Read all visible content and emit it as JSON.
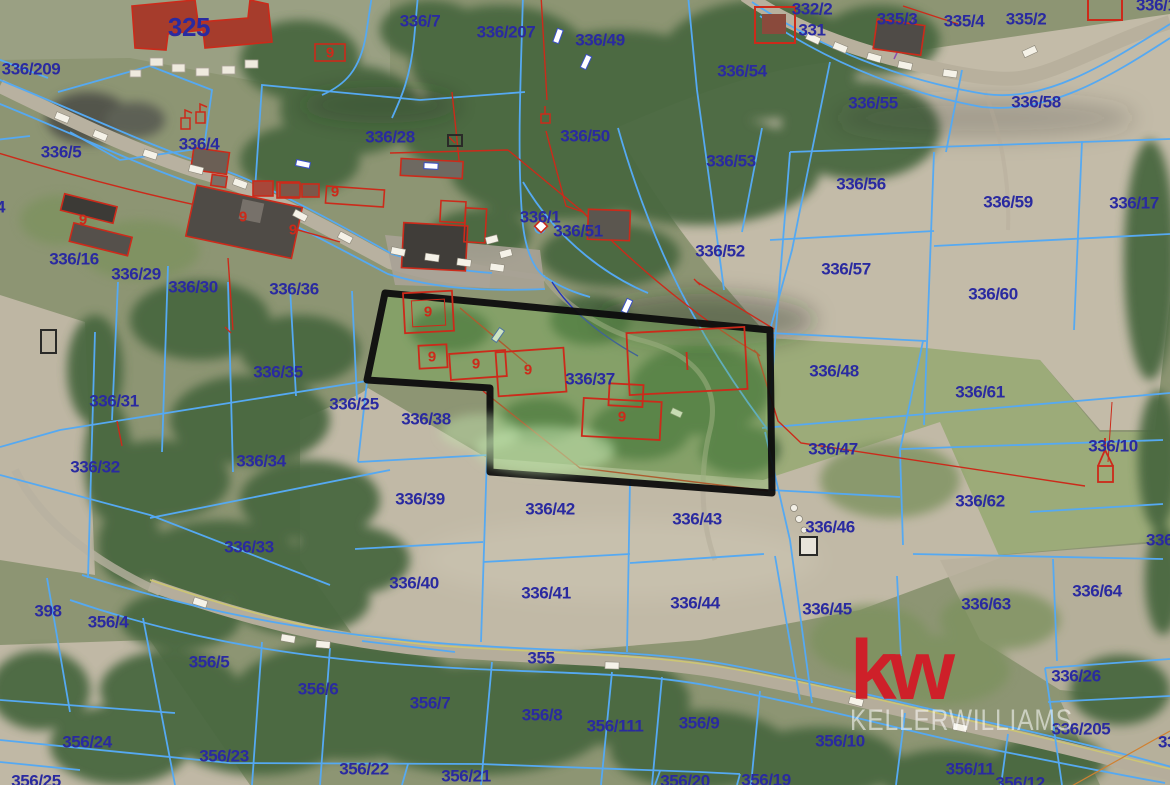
{
  "map": {
    "title": "cadastral-aerial-map",
    "colors": {
      "label_blue": "#2a2aa0",
      "line_blue": "#55a9f2",
      "cadastral_red": "#cc2a1a",
      "purple_line": "#8a4fae",
      "highlight_border": "#0d0d0d",
      "kw_red": "#ce2029"
    },
    "watermark": {
      "logo": "kw",
      "name": "KELLERWILLIAMS"
    },
    "highlighted_parcel": "336/37",
    "parcel_labels": [
      {
        "t": "325",
        "x": 189,
        "y": 27,
        "fs": 26
      },
      {
        "t": "336/209",
        "x": 31,
        "y": 69
      },
      {
        "t": "336/5",
        "x": 61,
        "y": 152
      },
      {
        "t": "336/4",
        "x": 199,
        "y": 144
      },
      {
        "t": "4",
        "x": -4,
        "y": 207,
        "anchor": "left"
      },
      {
        "t": "336/7",
        "x": 420,
        "y": 21
      },
      {
        "t": "336/207",
        "x": 506,
        "y": 32
      },
      {
        "t": "336/49",
        "x": 600,
        "y": 40
      },
      {
        "t": "336/54",
        "x": 742,
        "y": 71
      },
      {
        "t": "332/2",
        "x": 812,
        "y": 9
      },
      {
        "t": "331",
        "x": 812,
        "y": 30
      },
      {
        "t": "335/3",
        "x": 897,
        "y": 19
      },
      {
        "t": "335/4",
        "x": 964,
        "y": 21
      },
      {
        "t": "335/2",
        "x": 1026,
        "y": 19
      },
      {
        "t": "336/1",
        "x": 1136,
        "y": 5,
        "anchor": "left"
      },
      {
        "t": "336/55",
        "x": 873,
        "y": 103
      },
      {
        "t": "336/58",
        "x": 1036,
        "y": 102
      },
      {
        "t": "336/28",
        "x": 390,
        "y": 137
      },
      {
        "t": "336/50",
        "x": 585,
        "y": 136
      },
      {
        "t": "336/53",
        "x": 731,
        "y": 161
      },
      {
        "t": "336/56",
        "x": 861,
        "y": 184
      },
      {
        "t": "336/59",
        "x": 1008,
        "y": 202
      },
      {
        "t": "336/17",
        "x": 1134,
        "y": 203
      },
      {
        "t": "336/1",
        "x": 540,
        "y": 217
      },
      {
        "t": "336/51",
        "x": 578,
        "y": 231
      },
      {
        "t": "336/52",
        "x": 720,
        "y": 251
      },
      {
        "t": "336/57",
        "x": 846,
        "y": 269
      },
      {
        "t": "336/60",
        "x": 993,
        "y": 294
      },
      {
        "t": "336/16",
        "x": 74,
        "y": 259
      },
      {
        "t": "336/29",
        "x": 136,
        "y": 274
      },
      {
        "t": "336/30",
        "x": 193,
        "y": 287
      },
      {
        "t": "336/36",
        "x": 294,
        "y": 289
      },
      {
        "t": "336/35",
        "x": 278,
        "y": 372
      },
      {
        "t": "336/31",
        "x": 114,
        "y": 401
      },
      {
        "t": "336/25",
        "x": 354,
        "y": 404
      },
      {
        "t": "336/38",
        "x": 426,
        "y": 419
      },
      {
        "t": "336/37",
        "x": 590,
        "y": 379
      },
      {
        "t": "336/34",
        "x": 261,
        "y": 461
      },
      {
        "t": "336/32",
        "x": 95,
        "y": 467
      },
      {
        "t": "336/48",
        "x": 834,
        "y": 371
      },
      {
        "t": "336/61",
        "x": 980,
        "y": 392
      },
      {
        "t": "336/47",
        "x": 833,
        "y": 449
      },
      {
        "t": "336/10",
        "x": 1113,
        "y": 446
      },
      {
        "t": "336/62",
        "x": 980,
        "y": 501
      },
      {
        "t": "336/46",
        "x": 830,
        "y": 527
      },
      {
        "t": "336/1",
        "x": 1146,
        "y": 540,
        "anchor": "left"
      },
      {
        "t": "336/39",
        "x": 420,
        "y": 499
      },
      {
        "t": "336/42",
        "x": 550,
        "y": 509
      },
      {
        "t": "336/43",
        "x": 697,
        "y": 519
      },
      {
        "t": "336/33",
        "x": 249,
        "y": 547
      },
      {
        "t": "336/40",
        "x": 414,
        "y": 583
      },
      {
        "t": "336/41",
        "x": 546,
        "y": 593
      },
      {
        "t": "336/44",
        "x": 695,
        "y": 603
      },
      {
        "t": "336/45",
        "x": 827,
        "y": 609
      },
      {
        "t": "336/63",
        "x": 986,
        "y": 604
      },
      {
        "t": "336/64",
        "x": 1097,
        "y": 591
      },
      {
        "t": "398",
        "x": 48,
        "y": 611
      },
      {
        "t": "356/4",
        "x": 108,
        "y": 622
      },
      {
        "t": "355",
        "x": 541,
        "y": 658
      },
      {
        "t": "356/5",
        "x": 209,
        "y": 662
      },
      {
        "t": "336/26",
        "x": 1076,
        "y": 676
      },
      {
        "t": "356/6",
        "x": 318,
        "y": 689
      },
      {
        "t": "356/7",
        "x": 430,
        "y": 703
      },
      {
        "t": "356/8",
        "x": 542,
        "y": 715
      },
      {
        "t": "356/111",
        "x": 615,
        "y": 726
      },
      {
        "t": "356/9",
        "x": 699,
        "y": 723
      },
      {
        "t": "336/205",
        "x": 1081,
        "y": 729
      },
      {
        "t": "356/10",
        "x": 840,
        "y": 741
      },
      {
        "t": "356/24",
        "x": 87,
        "y": 742
      },
      {
        "t": "356/23",
        "x": 224,
        "y": 756
      },
      {
        "t": "336",
        "x": 1158,
        "y": 742,
        "anchor": "left"
      },
      {
        "t": "356/11",
        "x": 970,
        "y": 769
      },
      {
        "t": "356/22",
        "x": 364,
        "y": 769
      },
      {
        "t": "356/21",
        "x": 466,
        "y": 776
      },
      {
        "t": "356/25",
        "x": 36,
        "y": 781
      },
      {
        "t": "356/20",
        "x": 685,
        "y": 781
      },
      {
        "t": "356/19",
        "x": 766,
        "y": 780
      },
      {
        "t": "356/12",
        "x": 1020,
        "y": 783
      }
    ],
    "building_labels": [
      {
        "t": "9",
        "x": 330,
        "y": 53
      },
      {
        "t": "9",
        "x": 83,
        "y": 220
      },
      {
        "t": "9",
        "x": 243,
        "y": 217
      },
      {
        "t": "9",
        "x": 293,
        "y": 230
      },
      {
        "t": "9",
        "x": 335,
        "y": 192
      },
      {
        "t": "9",
        "x": 428,
        "y": 312
      },
      {
        "t": "9",
        "x": 432,
        "y": 357
      },
      {
        "t": "9",
        "x": 476,
        "y": 364
      },
      {
        "t": "9",
        "x": 528,
        "y": 370
      },
      {
        "t": "9",
        "x": 622,
        "y": 417
      }
    ]
  }
}
